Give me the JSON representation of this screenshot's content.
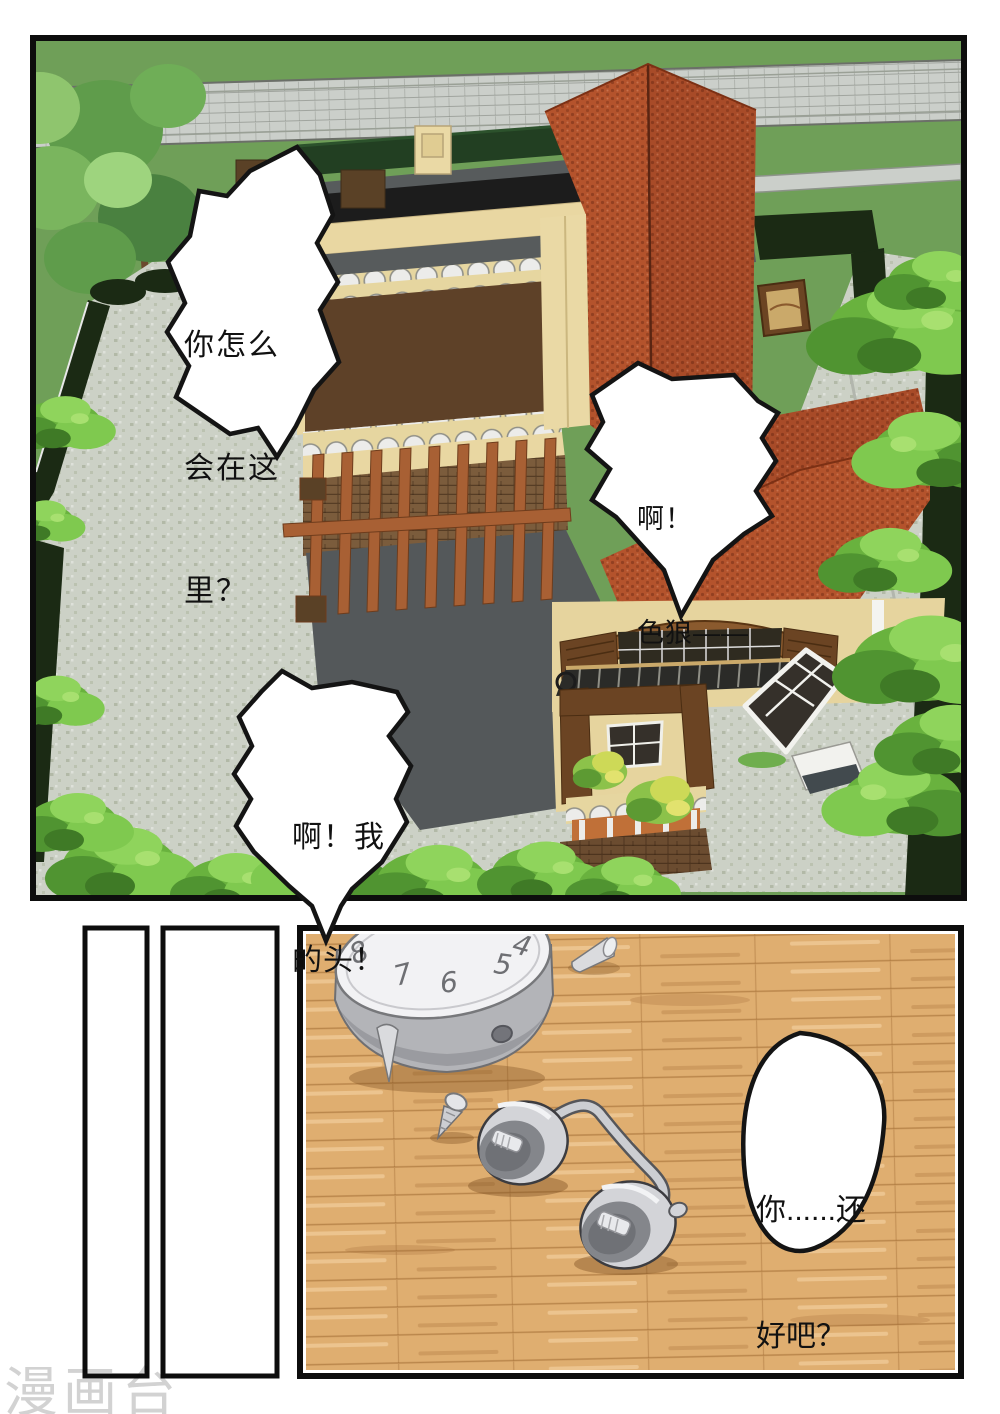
{
  "page": {
    "watermark": "漫画台"
  },
  "top_panel": {
    "bubble_shout_left": {
      "l1": "你怎么",
      "l2": "会在这",
      "l3": "里？"
    },
    "bubble_scream_right": {
      "l1": "啊！",
      "l2": "色狼——"
    }
  },
  "bottom_panel": {
    "bubble_my_head": {
      "l1": "啊！我",
      "l2": "的头！"
    },
    "bubble_are_you_ok": {
      "l1": "你......还",
      "l2": "好吧？"
    },
    "clock_numbers": {
      "n4": "4",
      "n5": "5",
      "n6": "6",
      "n7": "7",
      "n8": "8"
    }
  },
  "colors": {
    "lawn_green": "#6f9f58",
    "road_gray": "#cbcfca",
    "hedge_dark": "#1b2a14",
    "pavement": "#ccd1c6",
    "roof_red": "#b4532c",
    "roof_red_dark": "#a84b28",
    "wall_beige": "#e9d7a2",
    "wall_chocolate": "#5e4128",
    "terrace_gray": "#565a5b",
    "pergola_wood": "#a86034",
    "bush_green": "#69b23e",
    "floor_wood": "#dfae70",
    "metal_gray": "#b3b4b8",
    "bubble_fill": "#ffffff",
    "ink": "#141414"
  }
}
